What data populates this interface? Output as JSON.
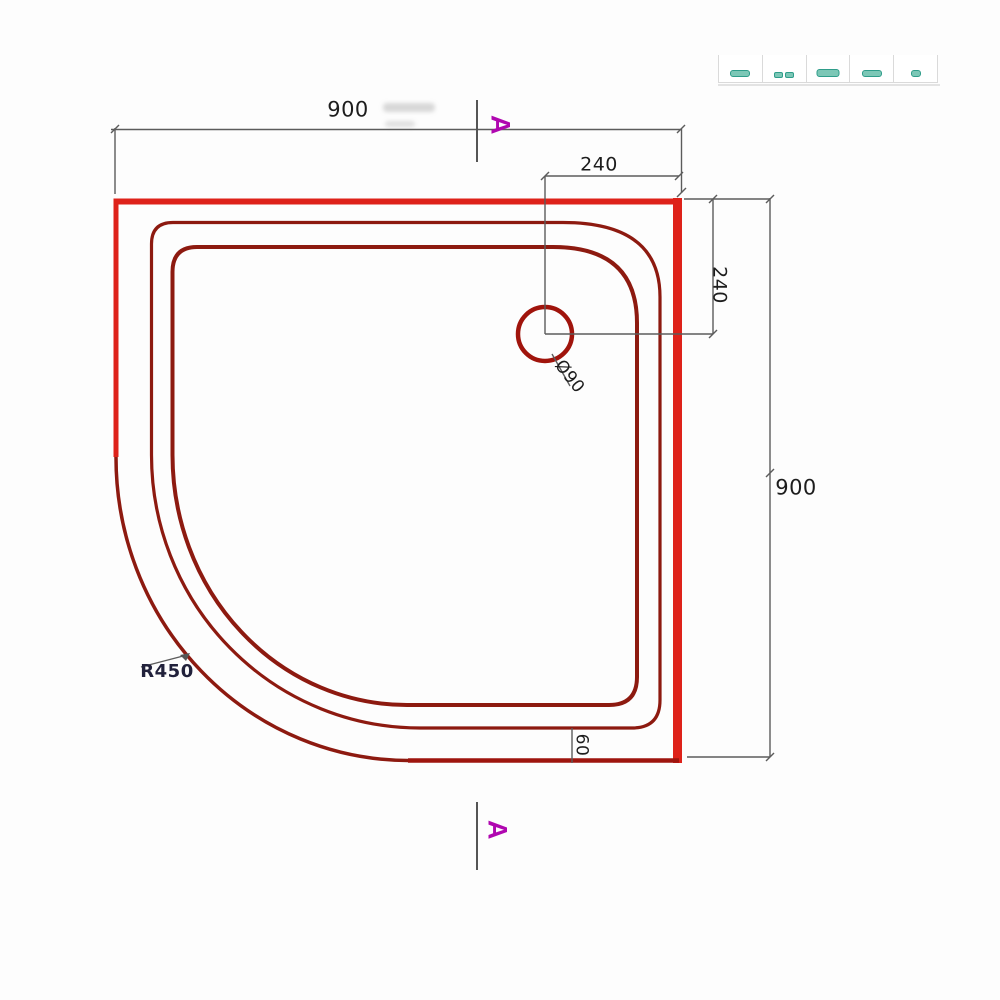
{
  "dimensions": {
    "top_width": "900",
    "right_height": "900",
    "drain_offset_top": "240",
    "drain_offset_right": "240",
    "drain_diameter": "Ø90",
    "corner_radius": "R450",
    "ledge_width": "60"
  },
  "section_markers": {
    "top": "A",
    "bottom": "A"
  },
  "toolbar": {
    "icons": [
      {
        "name": "cropped-teal-icon-1"
      },
      {
        "name": "cropped-teal-icon-2"
      },
      {
        "name": "cropped-teal-icon-3"
      },
      {
        "name": "cropped-teal-icon-4"
      },
      {
        "name": "cropped-teal-icon-5"
      }
    ]
  },
  "colors": {
    "rim_red": "#de221a",
    "bottom_red": "#9e150e",
    "profile_maroon": "#8d1a10",
    "drain_red": "#a0140c",
    "dimension_gray": "#5c5c5c",
    "text_dark": "#1d1d1d",
    "radius_text": "#21213b",
    "marker_magenta": "#b007b0",
    "icon_teal": "#2f9d8a",
    "icon_teal_fill": "#7cc7b6"
  }
}
